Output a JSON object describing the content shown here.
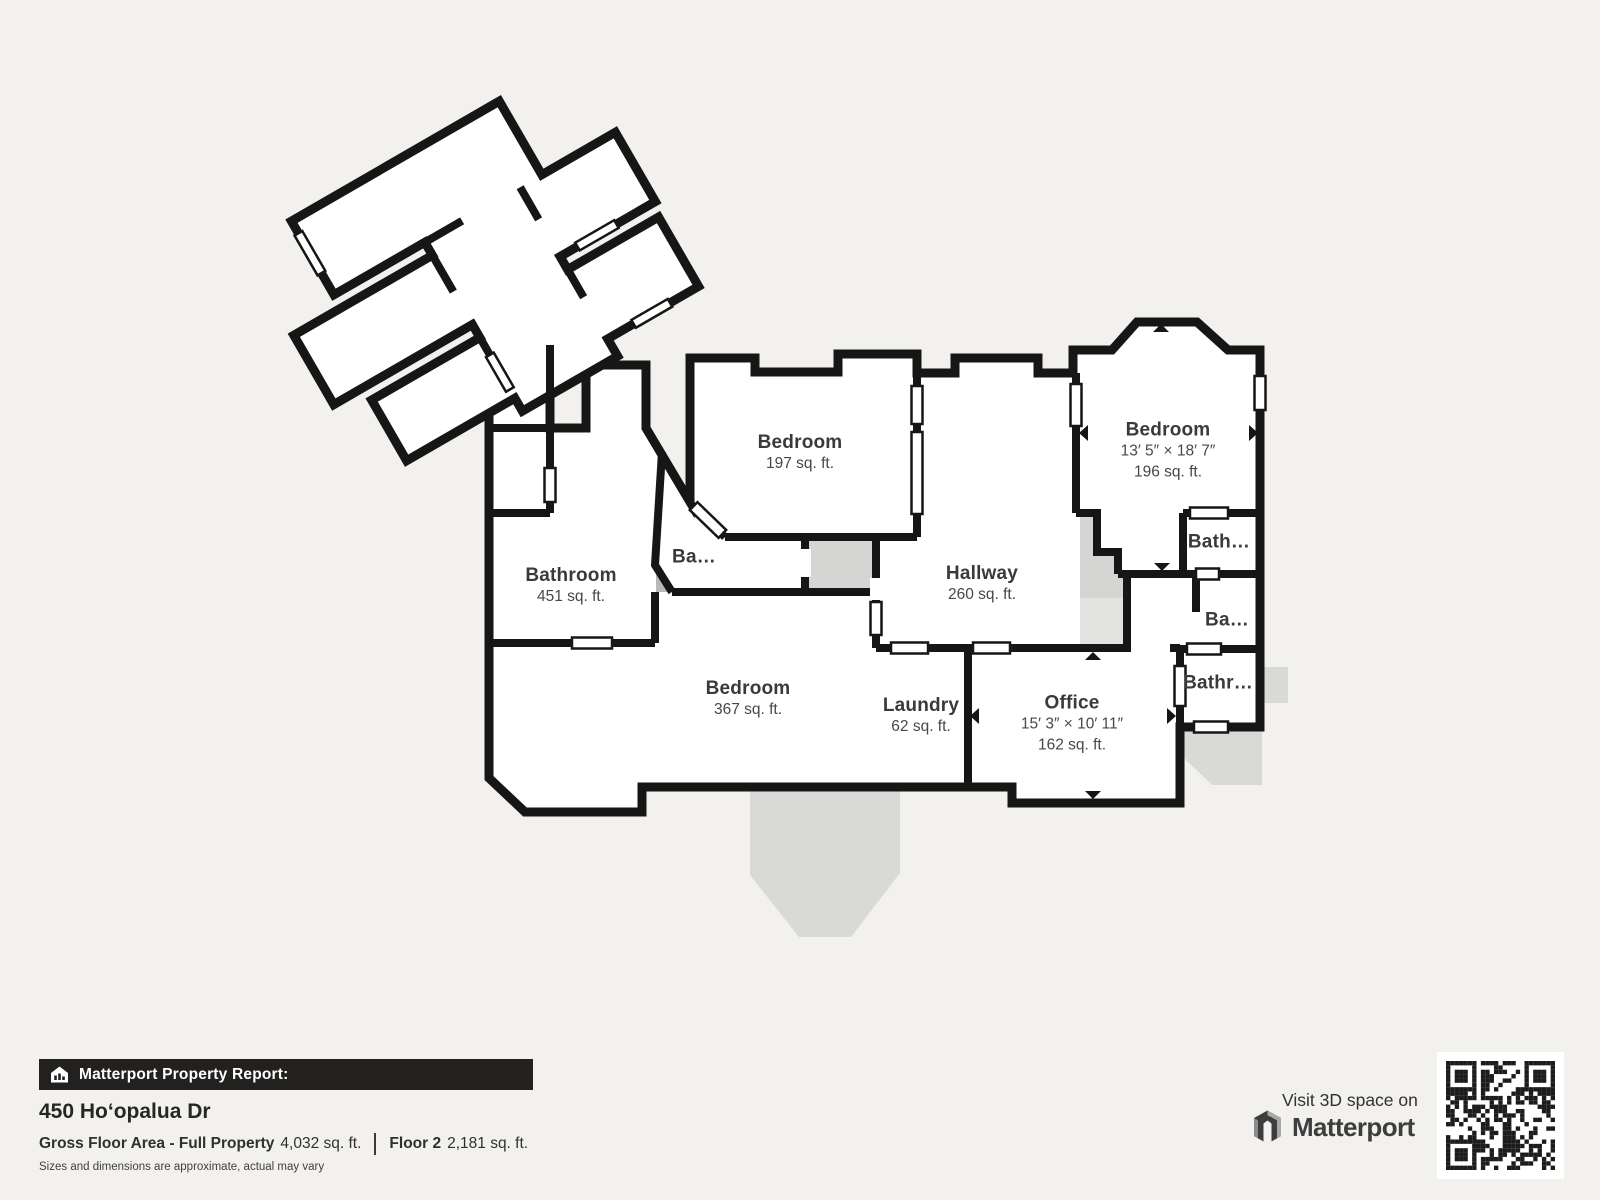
{
  "floorplan": {
    "rooms": [
      {
        "name": "Bedroom",
        "dims": "",
        "area": "197 sq. ft.",
        "x": 800,
        "y": 453
      },
      {
        "name": "Bedroom",
        "dims": "13′ 5″ × 18′ 7″",
        "area": "196 sq. ft.",
        "x": 1168,
        "y": 451
      },
      {
        "name": "Bathroom",
        "dims": "",
        "area": "451 sq. ft.",
        "x": 571,
        "y": 586
      },
      {
        "name": "Ba…",
        "dims": "",
        "area": "",
        "x": 694,
        "y": 557
      },
      {
        "name": "Hallway",
        "dims": "",
        "area": "260 sq. ft.",
        "x": 982,
        "y": 584
      },
      {
        "name": "Bath…",
        "dims": "",
        "area": "",
        "x": 1219,
        "y": 542
      },
      {
        "name": "Ba…",
        "dims": "",
        "area": "",
        "x": 1227,
        "y": 620
      },
      {
        "name": "Bedroom",
        "dims": "",
        "area": "367 sq. ft.",
        "x": 748,
        "y": 699
      },
      {
        "name": "Laundry",
        "dims": "",
        "area": "62 sq. ft.",
        "x": 921,
        "y": 716
      },
      {
        "name": "Office",
        "dims": "15′ 3″ × 10′ 11″",
        "area": "162 sq. ft.",
        "x": 1072,
        "y": 724
      },
      {
        "name": "Bathr…",
        "dims": "",
        "area": "",
        "x": 1218,
        "y": 683
      }
    ]
  },
  "footer": {
    "report_label": "Matterport Property Report:",
    "address": "450 Hoʻopalua Dr",
    "gfa_label": "Gross Floor Area - Full Property",
    "gfa_value": "4,032 sq. ft.",
    "floor_label": "Floor 2",
    "floor_value": "2,181 sq. ft.",
    "disclaimer": "Sizes and dimensions are approximate, actual may vary"
  },
  "cta": {
    "visit_text": "Visit 3D space on",
    "brand": "Matterport"
  },
  "icons": {
    "report_icon": "house-chart-icon",
    "brand_icon": "matterport-m-icon",
    "qr": "qr-code"
  },
  "colors": {
    "background": "#f2f1ee",
    "wall": "#161616",
    "floor": "#ffffff",
    "deck": "#d9d9d8",
    "stairs": "#d5d5d4",
    "text": "#3a3a3a"
  }
}
